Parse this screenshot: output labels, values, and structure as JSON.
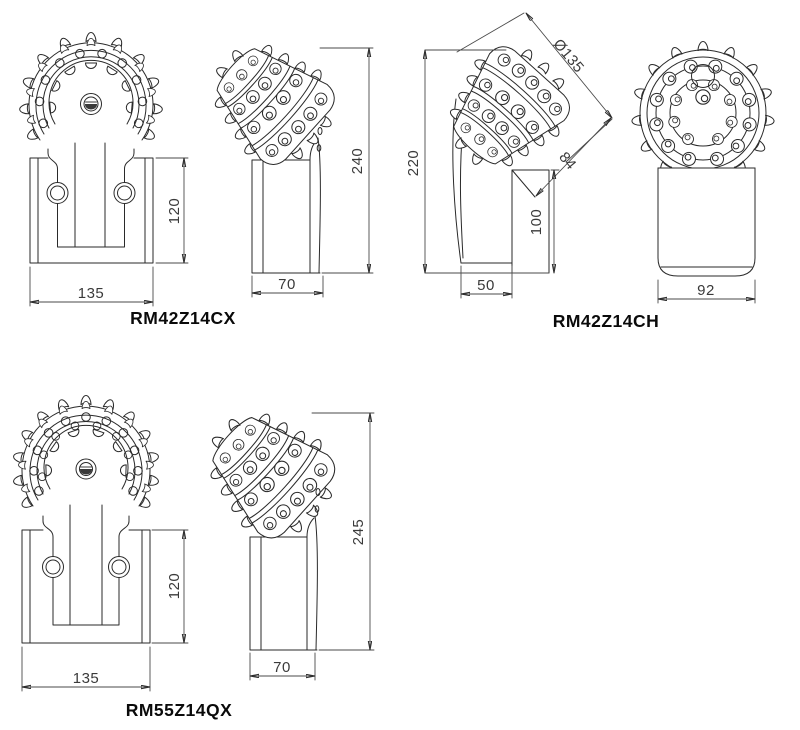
{
  "title": "Roller cone drill bit technical drawing",
  "colors": {
    "line": "#2a2a2a",
    "dim": "#4a4a4a",
    "text": "#3a3a3a",
    "label": "#0a0a0a",
    "background": "#ffffff"
  },
  "models": [
    {
      "label": "RM42Z14CX",
      "front_view": {
        "width": "135",
        "height": "120"
      },
      "side_view": {
        "width": "70",
        "height": "240"
      }
    },
    {
      "label": "RM42Z14CH",
      "angled_view": {
        "cone_diameter": "Ø135",
        "cone_length": "84",
        "overall_height": "220",
        "holder_height": "100",
        "holder_width": "50"
      },
      "face_view": {
        "width": "92"
      }
    },
    {
      "label": "RM55Z14QX",
      "front_view": {
        "width": "135",
        "height": "120"
      },
      "side_view": {
        "width": "70",
        "height": "245"
      }
    }
  ]
}
